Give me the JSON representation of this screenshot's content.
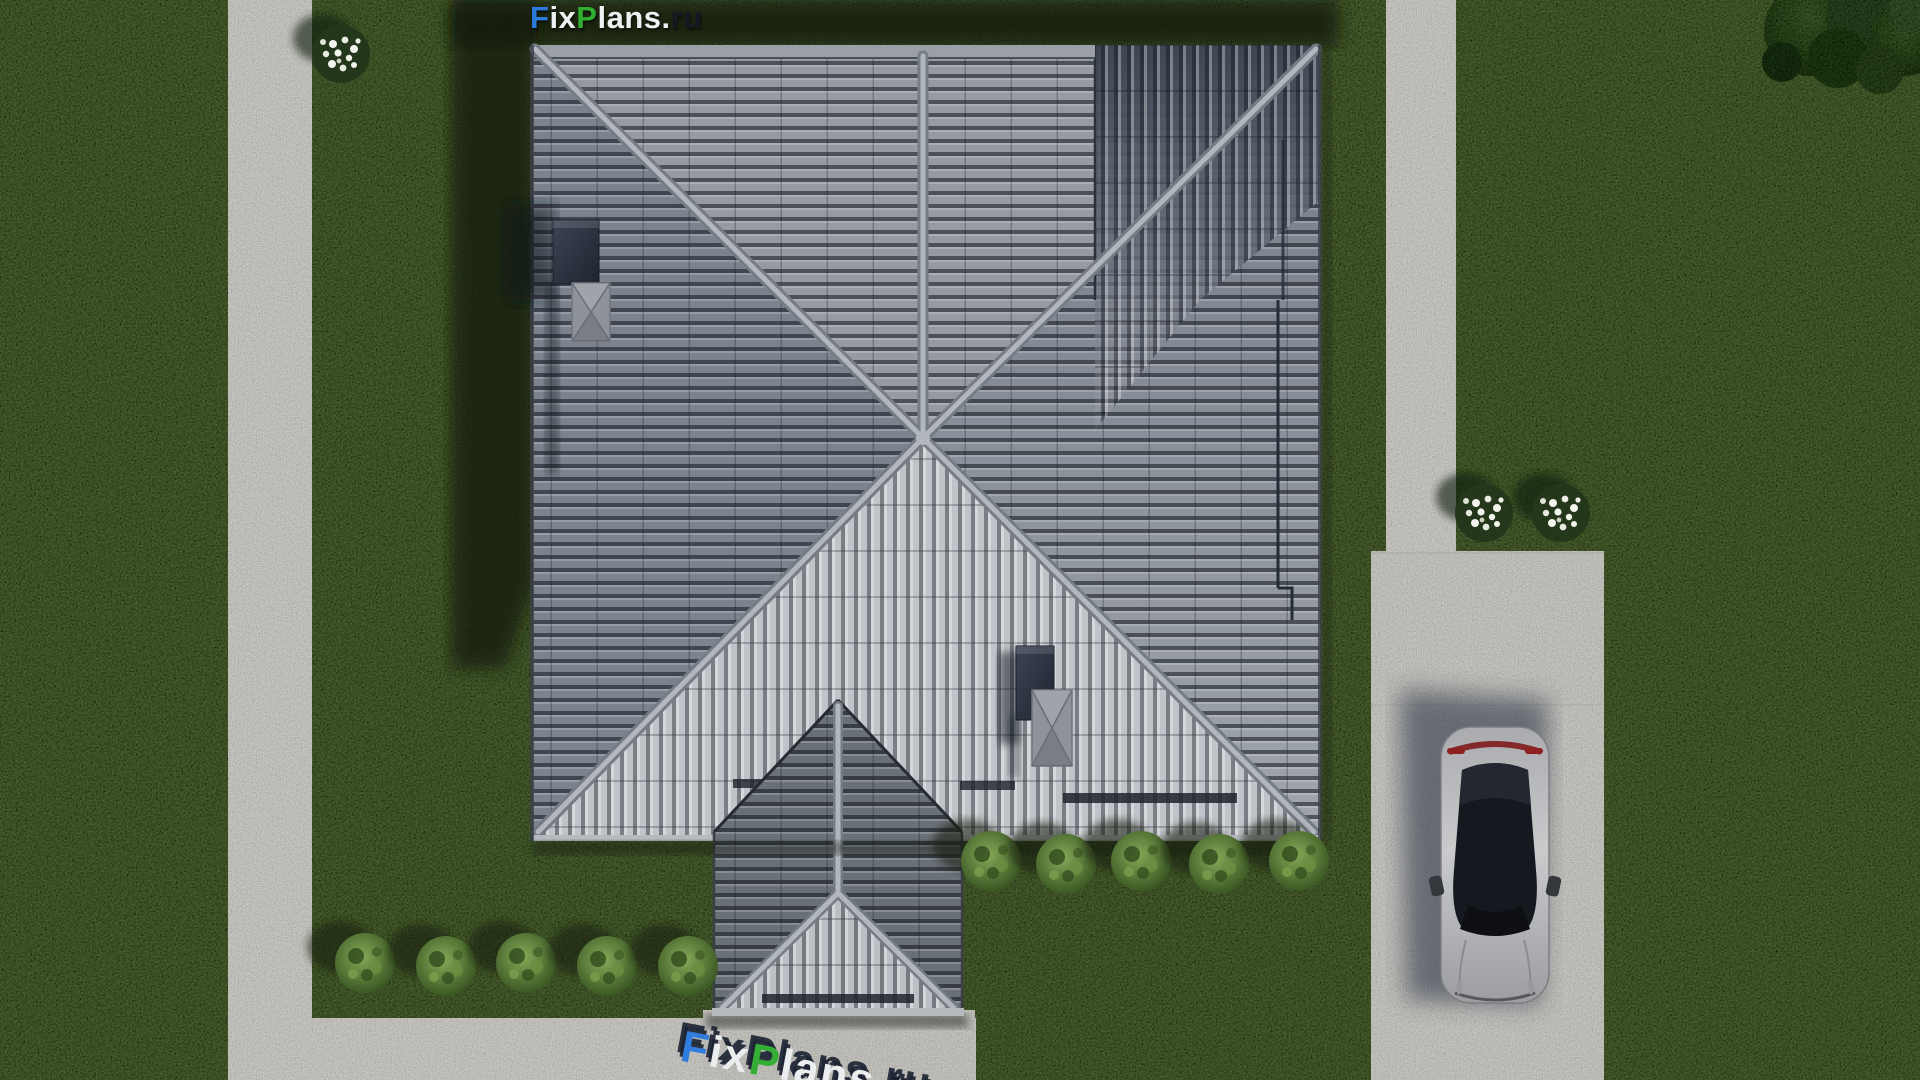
{
  "brand": {
    "full_text": "FixPlans.ru",
    "segments": {
      "f": "F",
      "ix": "ix",
      "p": "P",
      "lans": "lans",
      "dot": ".",
      "ru": "ru"
    },
    "colors": {
      "blue": "#2b7bdf",
      "green": "#2fae2f",
      "white": "#eef0f2",
      "dark": "#141a24"
    }
  },
  "scene": {
    "setting": "aerial top-down 3D architectural render of a house plot",
    "house": {
      "roof_style": "gray tiled hip roof with central hub and front porch gable",
      "skylight_count": 2,
      "chimney_count": 2,
      "roof_tile_light": "#b5b9bf",
      "roof_tile_dark": "#3e4757"
    },
    "grounds": {
      "grass_color": "#4d6530",
      "concrete_color": "#c9c8c3",
      "left_path": true,
      "bottom_walkway": true,
      "right_path": true,
      "driveway": true
    },
    "vehicle": {
      "type": "sedan seen from above",
      "color": "silver"
    },
    "vegetation": {
      "green_bushes_left_row": 5,
      "green_bushes_house_row": 5,
      "white_flower_bushes_left": 1,
      "white_flower_bushes_right": 2,
      "corner_tree": 1
    }
  }
}
